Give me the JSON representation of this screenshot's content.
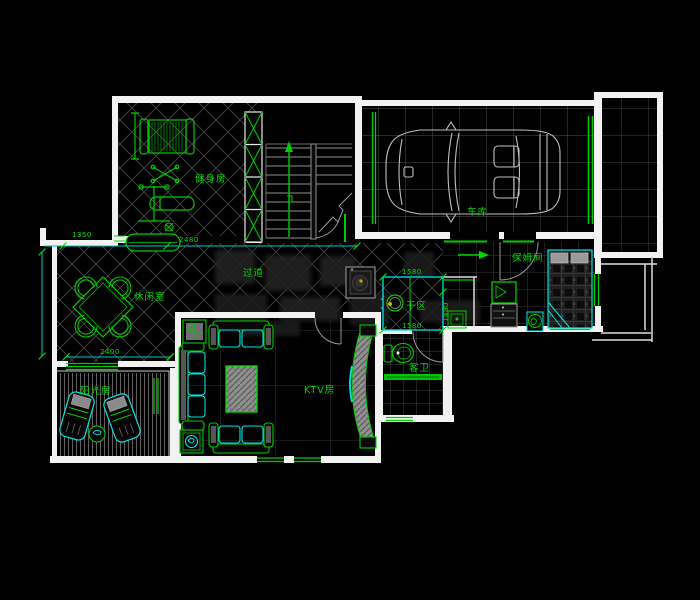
{
  "app": {
    "type": "cad-floor-plan"
  },
  "rooms": {
    "gym": {
      "label": "健身房"
    },
    "garage": {
      "label": "车库"
    },
    "hallway": {
      "label": "过道"
    },
    "lounge": {
      "label": "休闲室"
    },
    "sunroom": {
      "label": "阳光房"
    },
    "ktv": {
      "label": "KTV房"
    },
    "dry_area": {
      "label": "干区"
    },
    "guest_bath": {
      "label": "客卫"
    },
    "nanny_room": {
      "label": "保姆间"
    }
  },
  "dimensions": {
    "lounge_top_left": "1350",
    "lounge_top_right": "2480",
    "lounge_bottom": "2400",
    "dry_area_top": "1580",
    "dry_area_bottom": "1580",
    "dry_area_right": "1480"
  },
  "colors": {
    "background": "#000000",
    "walls": "#f2f2f2",
    "furniture_green": "#00cc00",
    "accent_cyan": "#00e6e6",
    "dimension_line_cyan": "#00c8c8",
    "hatch_gray": "#4a4a4a",
    "car_outline_gray": "#bfbfbf"
  }
}
